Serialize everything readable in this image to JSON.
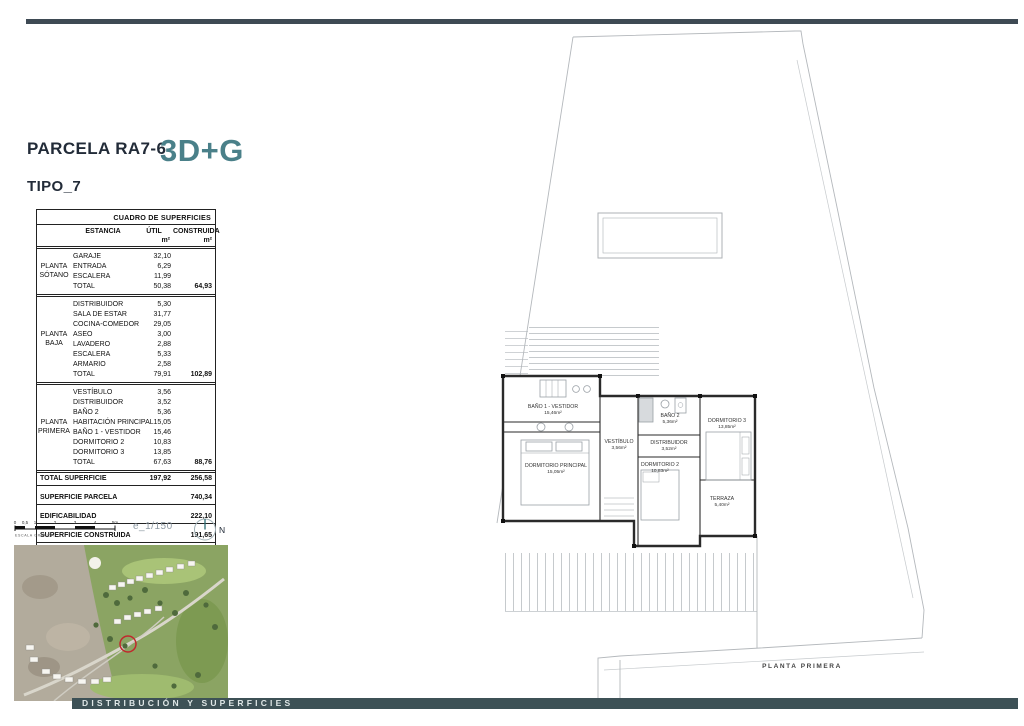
{
  "header": {
    "parcela": "PARCELA RA7-6",
    "model": "3D+G",
    "tipo": "TIPO_7"
  },
  "table": {
    "title": "CUADRO DE SUPERFICIES",
    "columns": {
      "estancia": "ESTANCIA",
      "util": "ÚTIL",
      "construida": "CONSTRUIDA",
      "unit": "m²"
    },
    "sections": [
      {
        "floor": "PLANTA SÓTANO",
        "rows": [
          {
            "label": "GARAJE",
            "util": "32,10"
          },
          {
            "label": "ENTRADA",
            "util": "6,29"
          },
          {
            "label": "ESCALERA",
            "util": "11,99"
          }
        ],
        "total": {
          "label": "TOTAL",
          "util": "50,38",
          "construida": "64,93"
        }
      },
      {
        "floor": "PLANTA BAJA",
        "rows": [
          {
            "label": "DISTRIBUIDOR",
            "util": "5,30"
          },
          {
            "label": "SALA DE ESTAR",
            "util": "31,77"
          },
          {
            "label": "COCINA-COMEDOR",
            "util": "29,05"
          },
          {
            "label": "ASEO",
            "util": "3,00"
          },
          {
            "label": "LAVADERO",
            "util": "2,88"
          },
          {
            "label": "ESCALERA",
            "util": "5,33"
          },
          {
            "label": "ARMARIO",
            "util": "2,58"
          }
        ],
        "total": {
          "label": "TOTAL",
          "util": "79,91",
          "construida": "102,89"
        }
      },
      {
        "floor": "PLANTA PRIMERA",
        "rows": [
          {
            "label": "VESTÍBULO",
            "util": "3,56"
          },
          {
            "label": "DISTRIBUIDOR",
            "util": "3,52"
          },
          {
            "label": "BAÑO 2",
            "util": "5,36"
          },
          {
            "label": "HABITACIÓN PRINCIPAL",
            "util": "15,05"
          },
          {
            "label": "BAÑO 1 - VESTIDOR",
            "util": "15,46"
          },
          {
            "label": "DORMITORIO 2",
            "util": "10,83"
          },
          {
            "label": "DORMITORIO 3",
            "util": "13,85"
          }
        ],
        "total": {
          "label": "TOTAL",
          "util": "67,63",
          "construida": "88,76"
        }
      }
    ],
    "summary": [
      {
        "label": "TOTAL SUPERFICIE",
        "util": "197,92",
        "construida": "256,58"
      },
      {
        "label": "SUPERFICIE PARCELA",
        "construida": "740,34"
      },
      {
        "label": "EDIFICABILIDAD",
        "construida": "222,10"
      },
      {
        "label": "SUPERFICIE CONSTRUIDA",
        "construida": "191,65"
      }
    ]
  },
  "scale": {
    "ticks": [
      "0",
      "0,5",
      "1",
      "2",
      "3",
      "4",
      "5m"
    ],
    "caption": "ESCALA GRÁFICA",
    "ratio": "e_1/150",
    "north": "N"
  },
  "plan": {
    "caption": "PLANTA PRIMERA",
    "rooms": [
      {
        "name": "BAÑO 1 - VESTIDOR",
        "area": "15,46m²"
      },
      {
        "name": "DORMITORIO PRINCIPAL",
        "area": "15,05m²"
      },
      {
        "name": "VESTÍBULO",
        "area": "3,56m²"
      },
      {
        "name": "DISTRIBUIDOR",
        "area": "3,52m²"
      },
      {
        "name": "BAÑO 2",
        "area": "5,36m²"
      },
      {
        "name": "DORMITORIO 3",
        "area": "13,85m²"
      },
      {
        "name": "DORMITORIO 2",
        "area": "10,83m²"
      },
      {
        "name": "TERRAZA",
        "area": "5,40m²"
      }
    ]
  },
  "footer": {
    "label": "DISTRIBUCIÓN Y SUPERFICIES"
  },
  "colors": {
    "accent_teal": "#4a8089",
    "dark_navy": "#222b38",
    "top_bar": "#3e4a54",
    "footer_bar": "#3d5156",
    "marker_red": "#c1272d"
  }
}
